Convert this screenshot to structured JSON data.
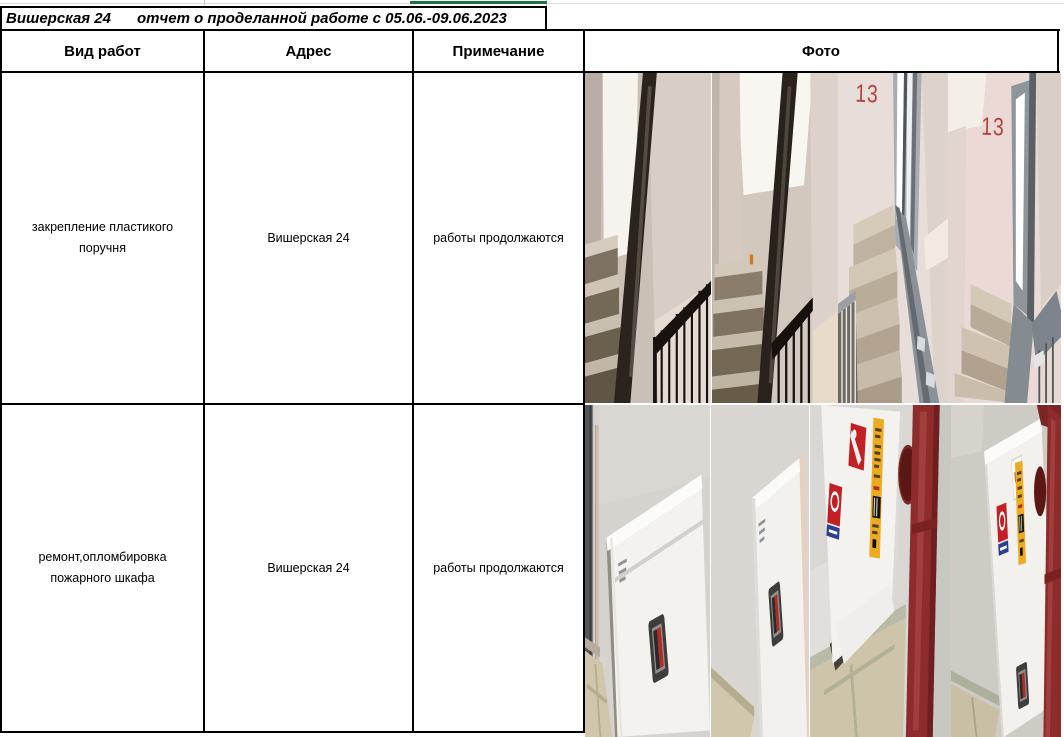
{
  "title": {
    "building": "Вишерская 24",
    "report": "отчет о проделанной работе с 05.06.-09.06.2023"
  },
  "table": {
    "columns": [
      {
        "label": "Вид работ"
      },
      {
        "label": "Адрес"
      },
      {
        "label": "Примечание"
      },
      {
        "label": "Фото"
      }
    ],
    "rows": [
      {
        "work": "закрепление пластикого поручня",
        "address": "Вишерская 24",
        "note": "работы продолжаются",
        "photos": [
          {
            "name": "stairwell-dark-flight-1",
            "label": ""
          },
          {
            "name": "stairwell-dark-flight-2",
            "label": ""
          },
          {
            "name": "stairwell-floor-13-a",
            "label": "13"
          },
          {
            "name": "stairwell-floor-13-b",
            "label": "13"
          }
        ]
      },
      {
        "work": "ремонт,опломбировка пожарного шкафа",
        "address": "Вишерская 24",
        "note": "работы продолжаются",
        "photos": [
          {
            "name": "fire-cabinet-closed-1",
            "label": ""
          },
          {
            "name": "fire-cabinet-closed-2",
            "label": ""
          },
          {
            "name": "fire-cabinet-stickers-pipe-1",
            "label": ""
          },
          {
            "name": "fire-cabinet-stickers-pipe-2",
            "label": ""
          }
        ]
      }
    ]
  },
  "colors": {
    "table_border": "#000000",
    "grid_line": "#c9c9c9",
    "selection_green": "#1e7145",
    "floor_label_red": "#b5413e",
    "pipe_red": "#8e2b2b",
    "sticker_red": "#c32026",
    "sticker_yellow": "#ecab22",
    "sticker_blue": "#2b3f8e",
    "handle_red": "#b32a24"
  }
}
